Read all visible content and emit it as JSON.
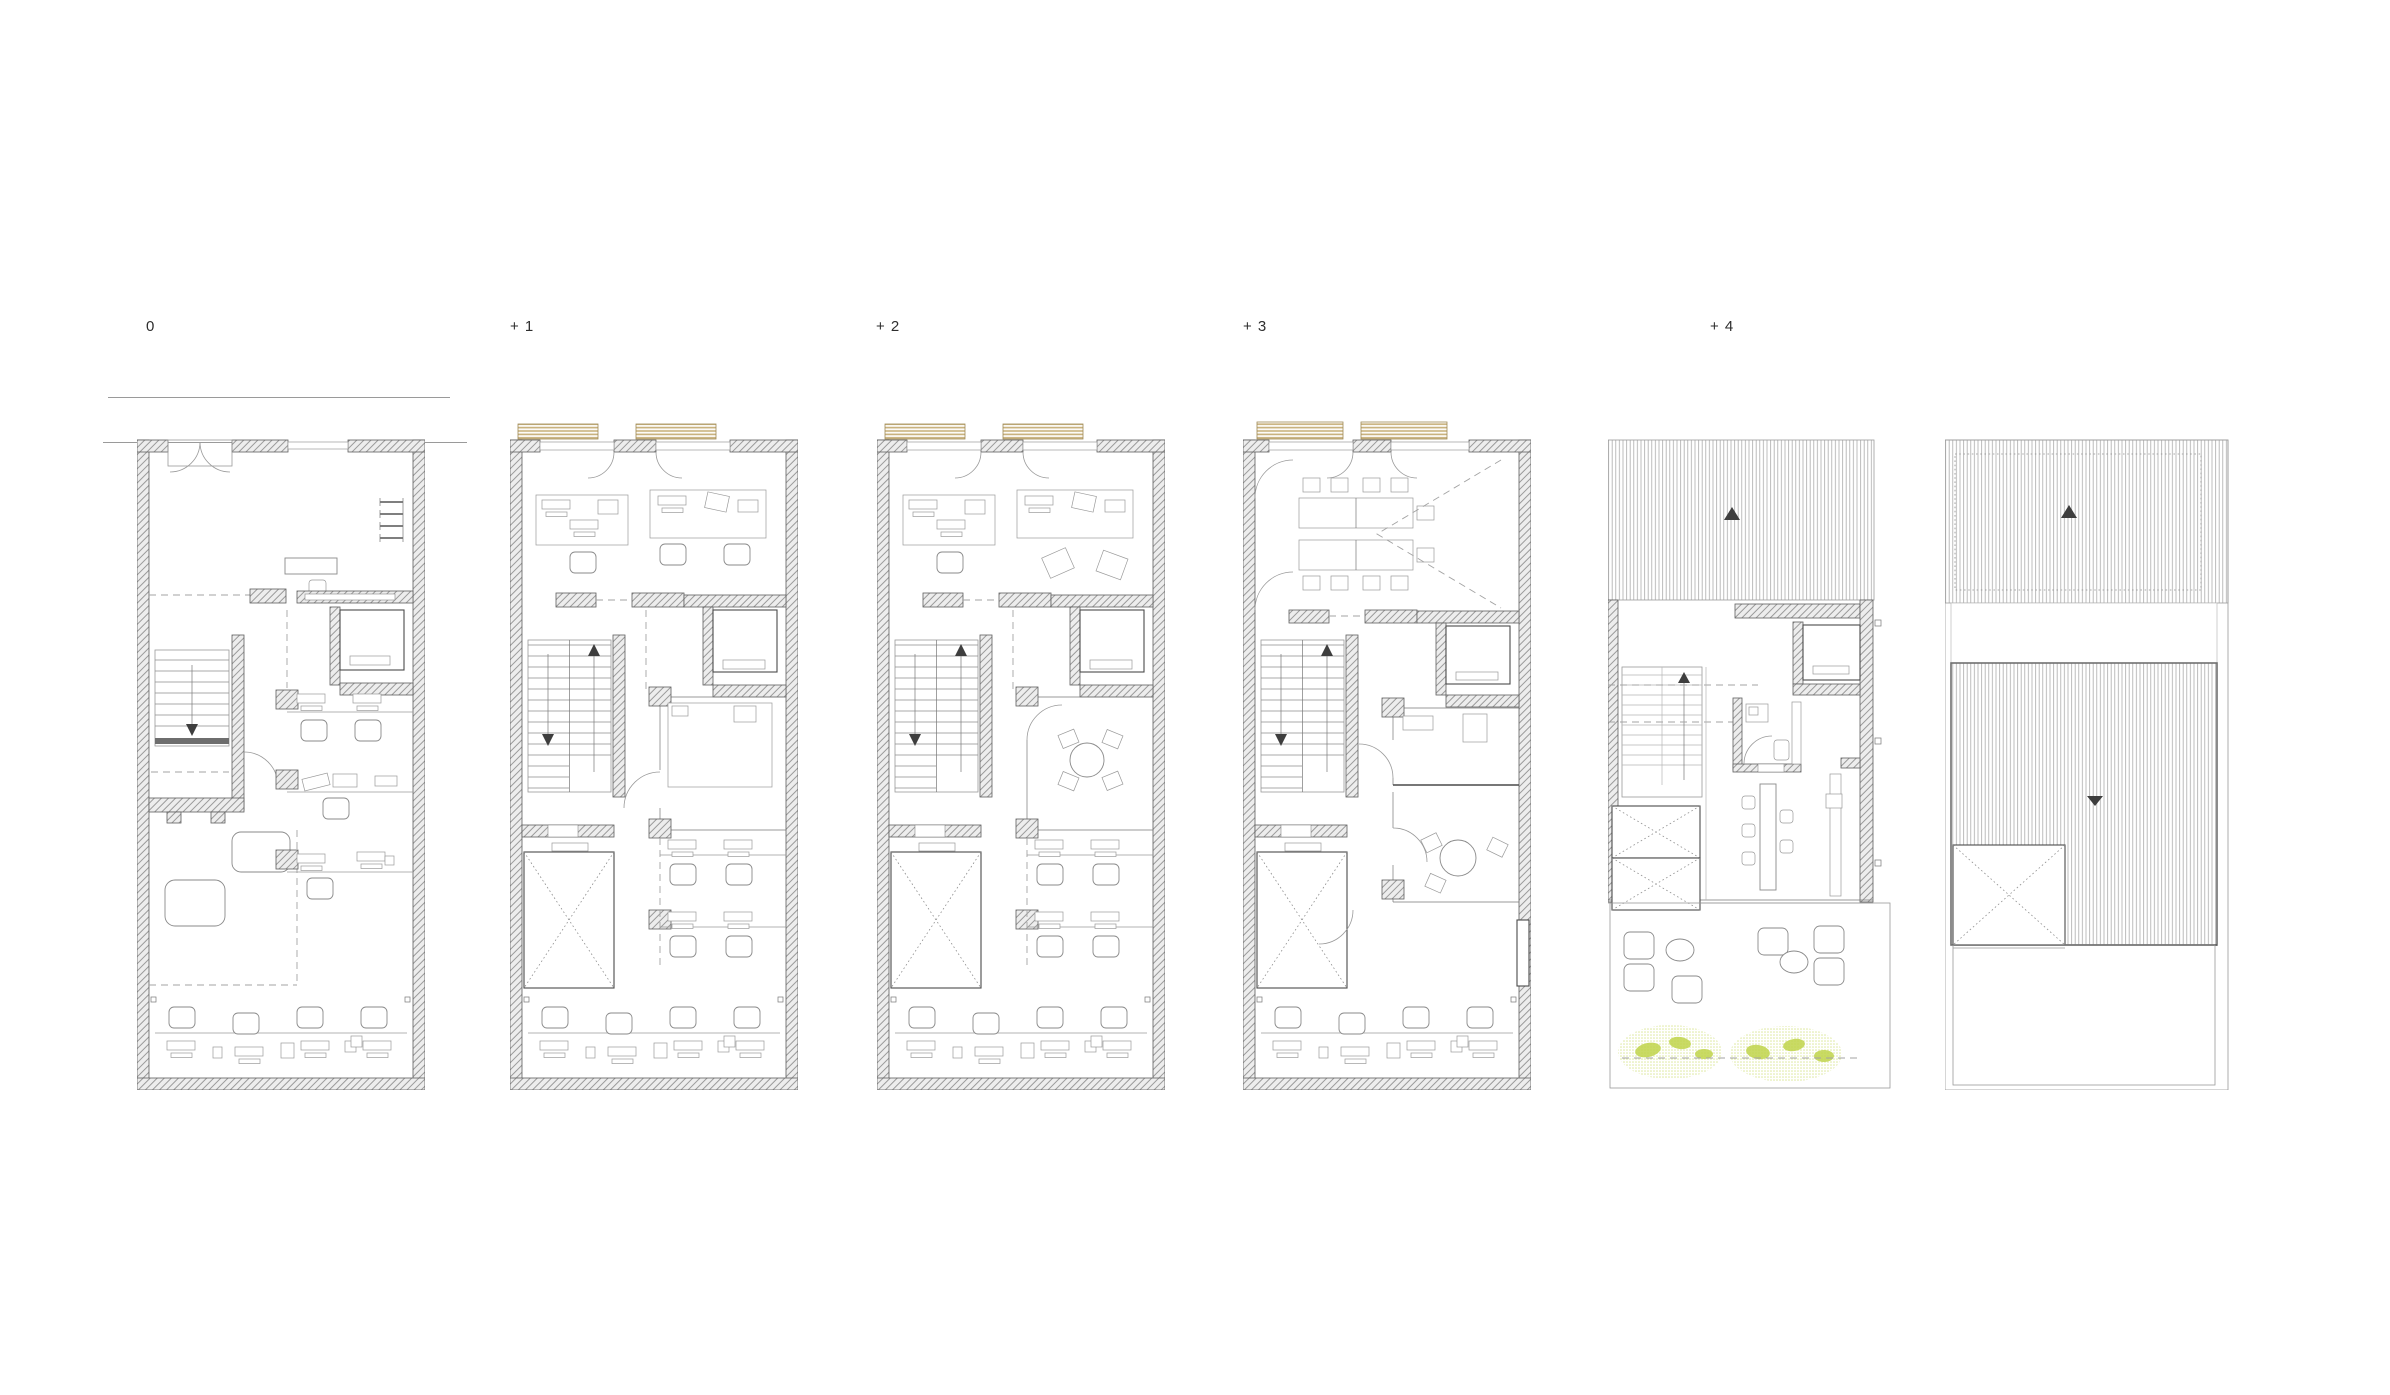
{
  "sheet": {
    "type": "architectural-floor-plan-series",
    "plan_count": 6
  },
  "levels": [
    {
      "id": "level-0",
      "label": "0"
    },
    {
      "id": "level-1",
      "label": "+ 1"
    },
    {
      "id": "level-2",
      "label": "+ 2"
    },
    {
      "id": "level-3",
      "label": "+ 3"
    },
    {
      "id": "level-4",
      "label": "+ 4"
    },
    {
      "id": "roof",
      "label": ""
    }
  ],
  "colors": {
    "background": "#ffffff",
    "wall_fill": "#ededed",
    "wall_hatch_line": "#9a9a9a",
    "wall_outline": "#5e5e5e",
    "thin_line": "#777777",
    "dashed_line": "#a3a3a3",
    "awning_tan": "#c9b27e",
    "roof_hatch": "#ababab",
    "vegetation_light": "#dde79c",
    "vegetation_dark": "#bfd44a",
    "stair_arrow": "#3e3e3e"
  }
}
